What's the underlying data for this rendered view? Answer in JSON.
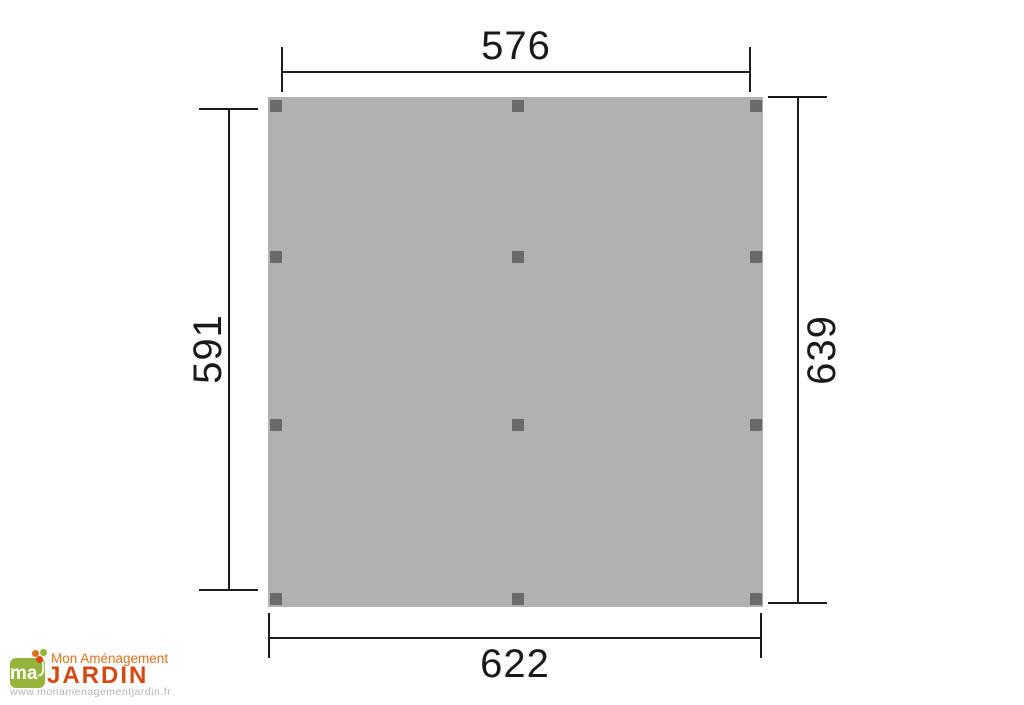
{
  "drawing": {
    "type": "carport-floor-plan",
    "dimensions": {
      "top": "576",
      "bottom": "622",
      "left": "591",
      "right": "639"
    },
    "posts": {
      "cols": [
        270,
        512,
        750
      ],
      "rows": [
        100,
        251,
        419,
        593
      ],
      "size": 12
    },
    "colors": {
      "panel": "#b1b1b1",
      "post": "#6a6a6a",
      "ink": "#1a1a1a"
    }
  },
  "logo": {
    "monogram": "ma",
    "brand_top": "Mon Aménagement",
    "brand_main": "JARDIN",
    "website": "www.monamenagementjardin.fr",
    "colors": {
      "green": "#94b43b",
      "orange": "#e0701d",
      "dark_orange": "#d44a12",
      "gray": "#b3b3b3"
    }
  }
}
